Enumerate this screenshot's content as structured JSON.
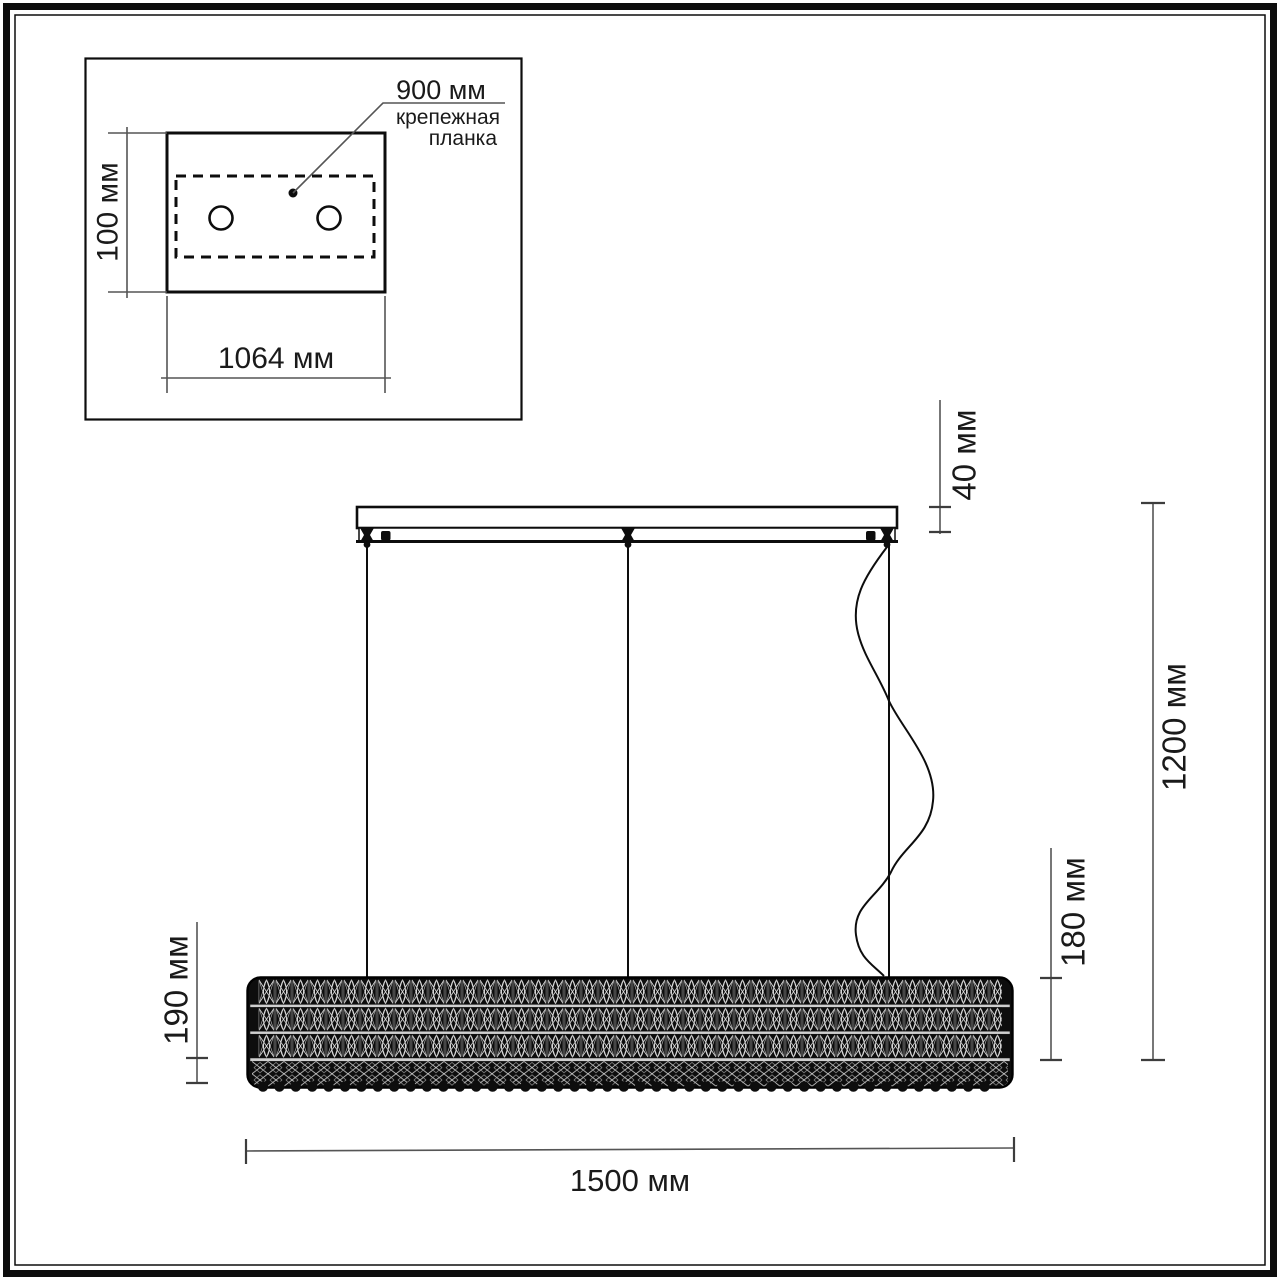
{
  "drawing": {
    "inset": {
      "plate_width_label": "1064 мм",
      "plate_height_label": "100 мм",
      "hole_spacing_label": "900 мм",
      "mount_bar_label_line1": "крепежная",
      "mount_bar_label_line2": "планка"
    },
    "side_view": {
      "canopy_height_label": "40 мм",
      "overall_height_label": "1200 мм",
      "body_height_right_label": "180 мм",
      "body_height_left_label": "190 мм",
      "body_length_label": "1500 мм"
    },
    "colors": {
      "outline": "#0d0d0d",
      "dimension_line": "#555555",
      "text": "#1a1a1a",
      "background": "#ffffff",
      "row_divider": "#cfcfcf"
    }
  }
}
